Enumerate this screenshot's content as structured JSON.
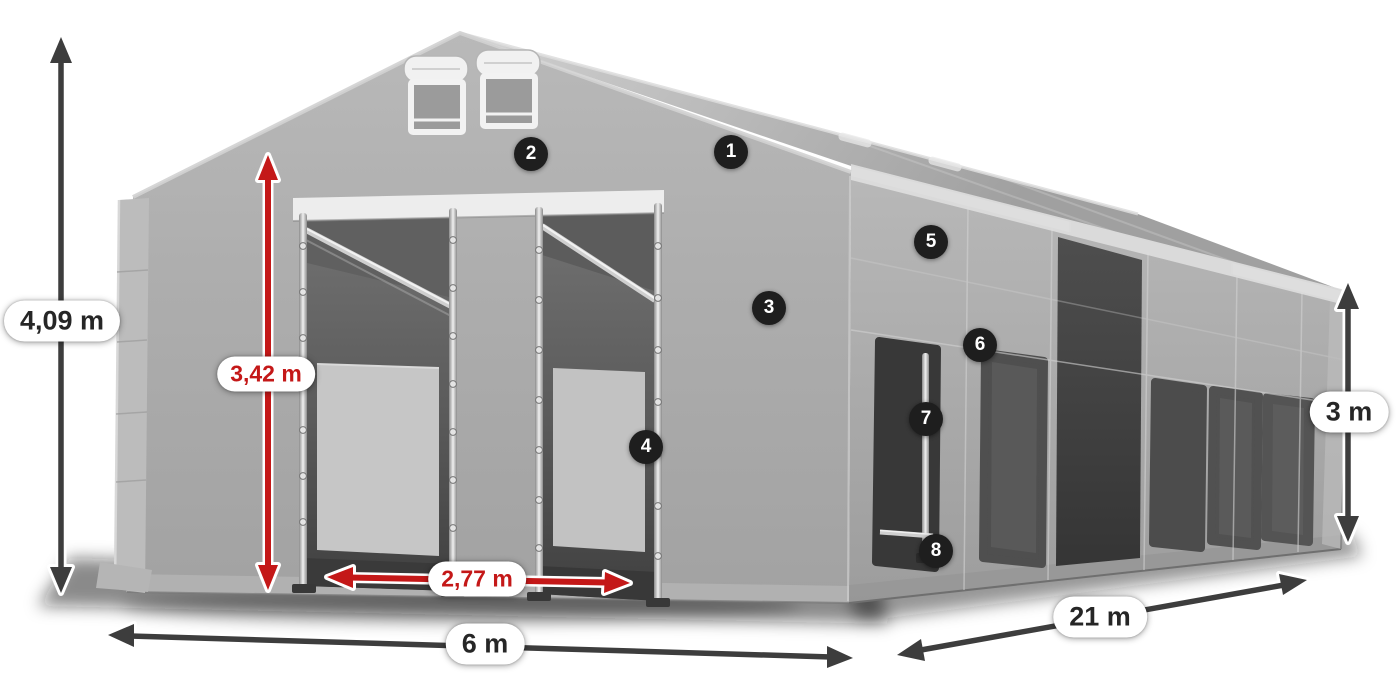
{
  "page": {
    "background": "#ffffff",
    "content_type": "tent-dimension-diagram"
  },
  "dimensions": [
    {
      "id": "total-height",
      "label": "4,09 m",
      "text_color": "#262626",
      "arrow_color": "#3d3d3d",
      "orientation": "vertical"
    },
    {
      "id": "entrance-height",
      "label": "3,42 m",
      "text_color": "#c41818",
      "arrow_color": "#c41818",
      "orientation": "vertical"
    },
    {
      "id": "entrance-width",
      "label": "2,77 m",
      "text_color": "#c41818",
      "arrow_color": "#c41818",
      "orientation": "horizontal"
    },
    {
      "id": "front-width",
      "label": "6 m",
      "text_color": "#262626",
      "arrow_color": "#3d3d3d",
      "orientation": "horizontal"
    },
    {
      "id": "side-length",
      "label": "21 m",
      "text_color": "#262626",
      "arrow_color": "#3d3d3d",
      "orientation": "diagonal"
    },
    {
      "id": "side-height",
      "label": "3 m",
      "text_color": "#262626",
      "arrow_color": "#3d3d3d",
      "orientation": "vertical"
    }
  ],
  "badges": [
    {
      "number": "1"
    },
    {
      "number": "2"
    },
    {
      "number": "3"
    },
    {
      "number": "4"
    },
    {
      "number": "5"
    },
    {
      "number": "6"
    },
    {
      "number": "7"
    },
    {
      "number": "8"
    }
  ],
  "colors": {
    "dimension_text_dark": "#262626",
    "dimension_text_red": "#c41818",
    "arrow_dark": "#3d3d3d",
    "arrow_red": "#c41818",
    "label_pill_background": "#ffffff",
    "badge_background": "#1e1e1e",
    "badge_text": "#ffffff",
    "tent_fabric": "#ababab",
    "tent_interior_dark": "#4a4a4a"
  }
}
